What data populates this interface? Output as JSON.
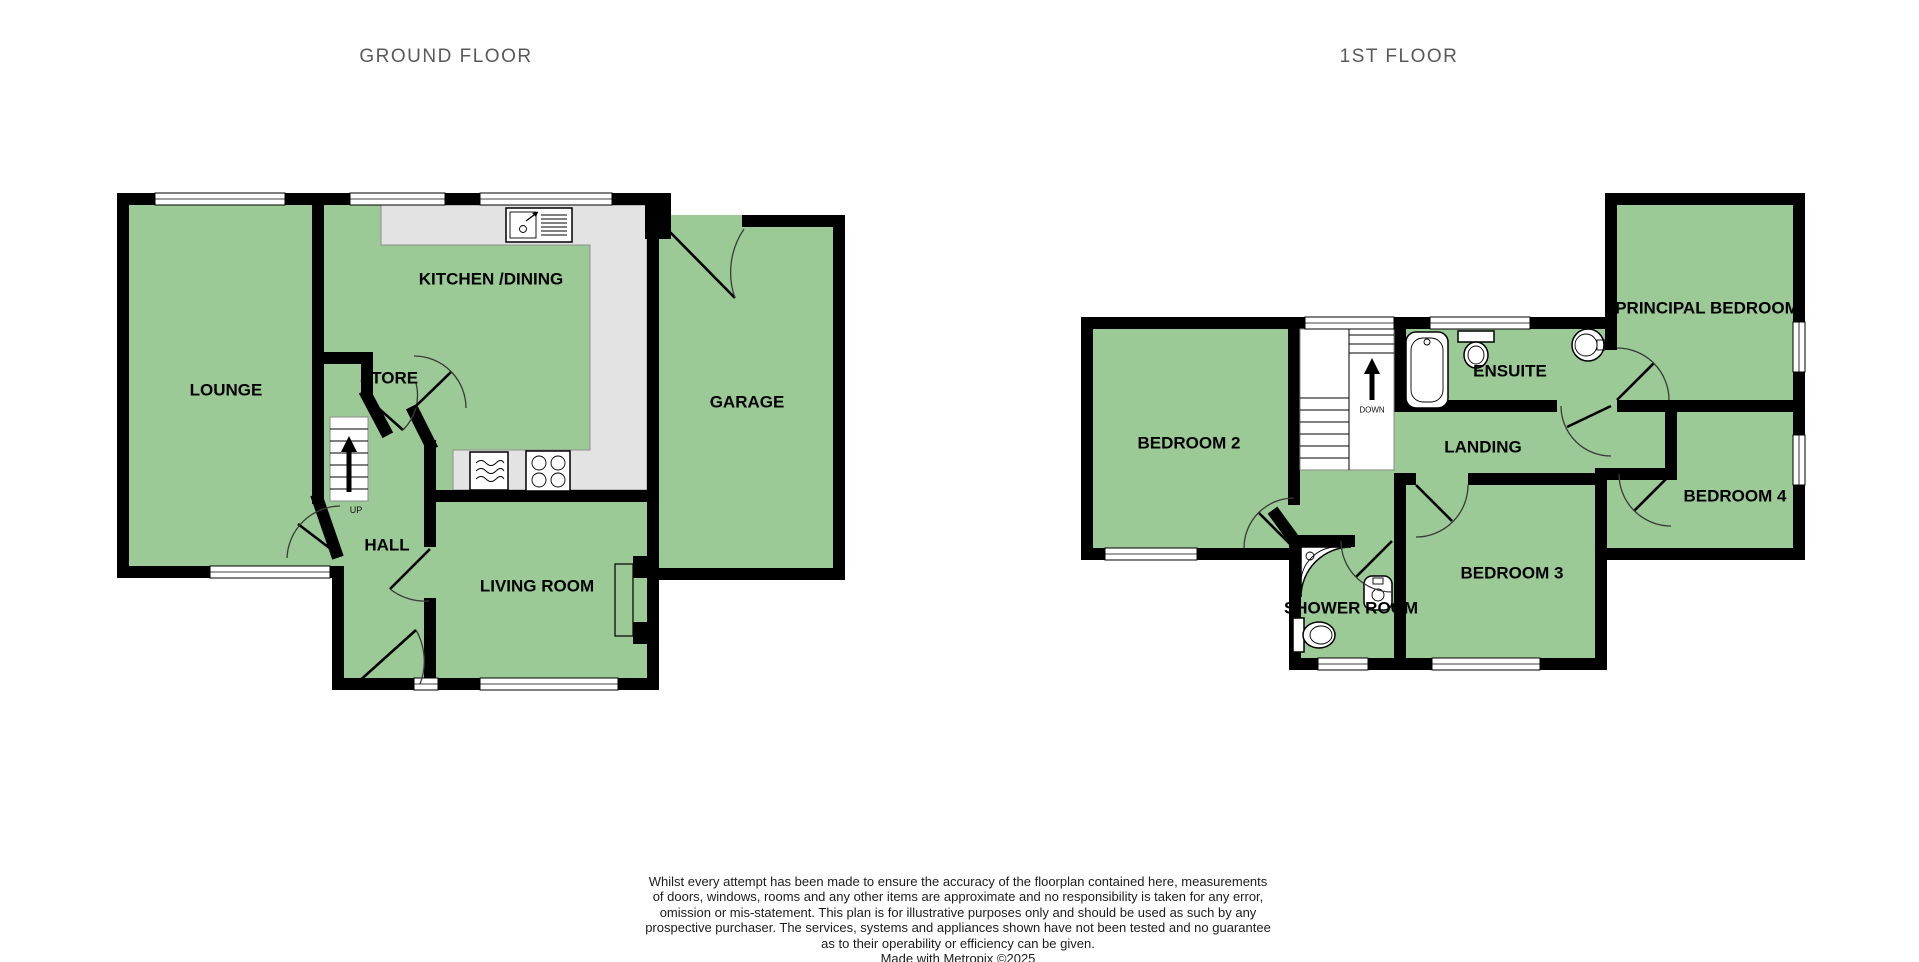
{
  "titles": {
    "ground_floor": "GROUND FLOOR",
    "first_floor": "1ST FLOOR"
  },
  "ground_floor": {
    "rooms": {
      "lounge": "LOUNGE",
      "kitchen_dining": "KITCHEN /DINING",
      "store": "STORE",
      "hall": "HALL",
      "living_room": "LIVING ROOM",
      "garage": "GARAGE"
    },
    "stairs_label": "UP"
  },
  "first_floor": {
    "rooms": {
      "bedroom2": "BEDROOM 2",
      "ensuite": "ENSUITE",
      "principal_bedroom": "PRINCIPAL BEDROOM",
      "landing": "LANDING",
      "bedroom4": "BEDROOM 4",
      "bedroom3": "BEDROOM 3",
      "shower_room": "SHOWER ROOM"
    },
    "stairs_label": "DOWN"
  },
  "colors": {
    "room_fill": "#9bca96",
    "wall": "#000000",
    "counter_fill": "#e3e3e3",
    "title_text": "#58595b"
  },
  "disclaimer": {
    "lines": [
      "Whilst every attempt has been made to ensure the accuracy of the floorplan contained here, measurements",
      "of doors, windows, rooms and any other items are approximate and no responsibility is taken for any error,",
      "omission or mis-statement. This plan is for illustrative purposes only and should be used as such by any",
      "prospective purchaser. The services, systems and appliances shown have not been tested and no guarantee",
      "as to their operability or efficiency can be given."
    ],
    "credit": "Made with Metropix ©2025"
  }
}
